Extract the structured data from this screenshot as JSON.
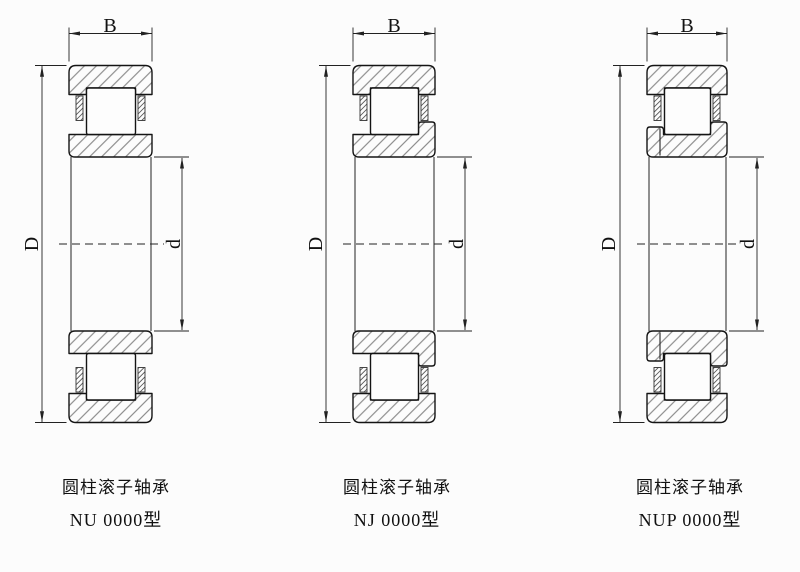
{
  "diagram": {
    "background_color": "#fcfcfc",
    "line_color": "#141414",
    "dim_line_color": "#222222",
    "hatch_color": "#787878",
    "dims": {
      "width_label": "B",
      "outer_diameter_label": "D",
      "bore_diameter_label": "d"
    },
    "bearings": [
      {
        "type": "NU",
        "caption_line1": "圆柱滚子轴承",
        "caption_line2": "NU 0000型"
      },
      {
        "type": "NJ",
        "caption_line1": "圆柱滚子轴承",
        "caption_line2": "NJ 0000型"
      },
      {
        "type": "NUP",
        "caption_line1": "圆柱滚子轴承",
        "caption_line2": "NUP 0000型"
      }
    ]
  }
}
